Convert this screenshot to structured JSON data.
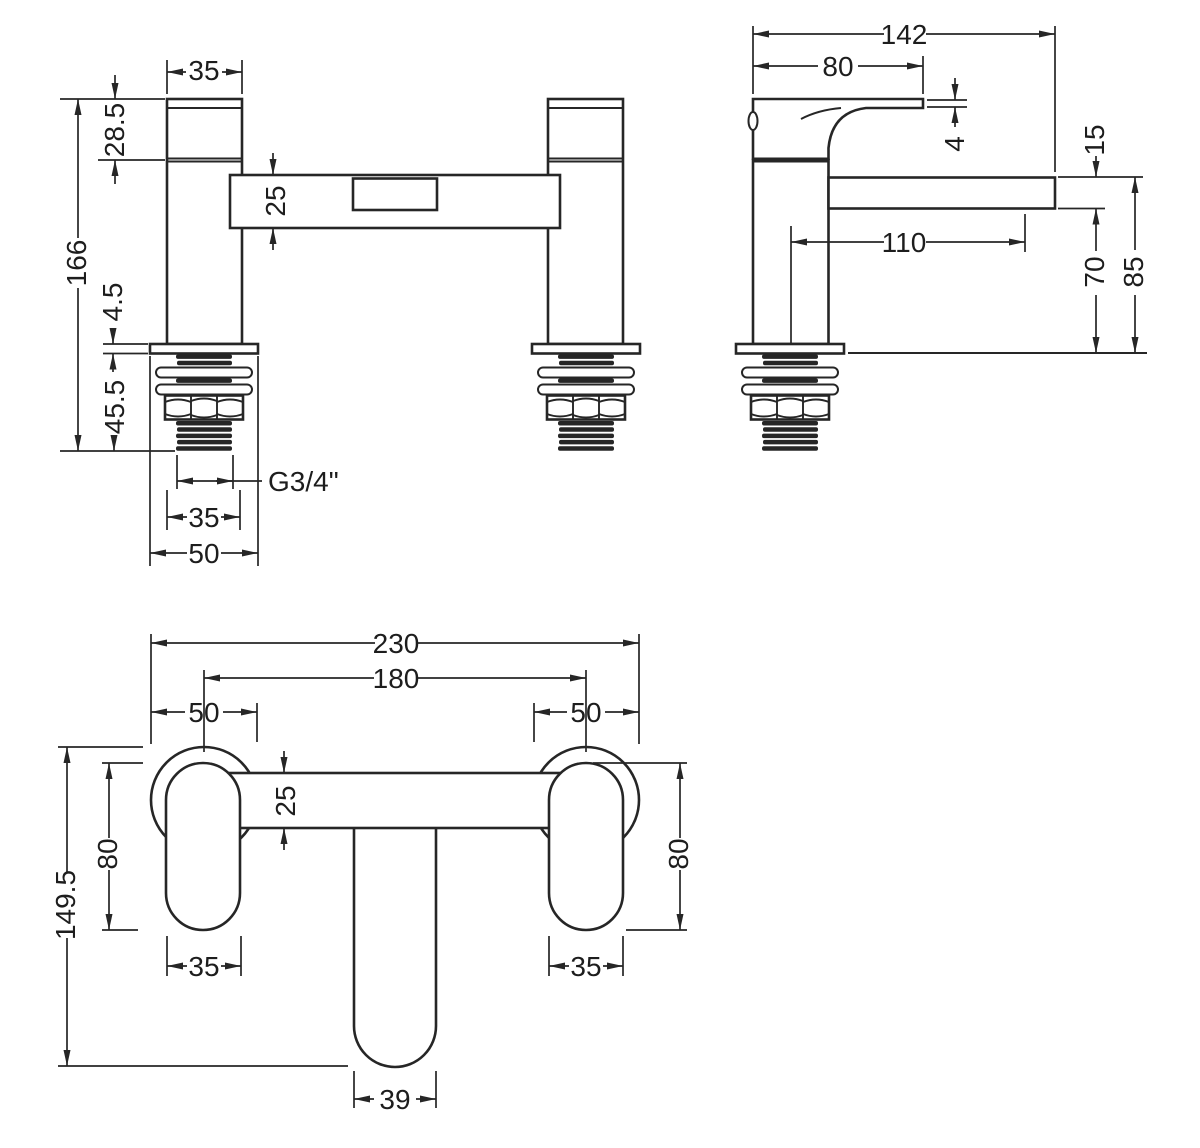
{
  "drawing": {
    "front": {
      "pillar_width": "35",
      "handle_height": "28.5",
      "bridge_height": "25",
      "total_height": "166",
      "flange_thickness": "4.5",
      "shank_length": "45.5",
      "thread_size": "G3/4\"",
      "thread_width": "35",
      "base_width": "50"
    },
    "side": {
      "total_depth": "142",
      "handle_depth": "80",
      "lever_thickness": "4",
      "spout_thickness": "15",
      "spout_reach": "110",
      "spout_clearance": "70",
      "spout_top_height": "85"
    },
    "plan": {
      "overall_width": "230",
      "hole_centres": "180",
      "base_left": "50",
      "base_right": "50",
      "bridge_depth": "25",
      "handle_left_length": "80",
      "handle_right_length": "80",
      "overall_depth": "149.5",
      "handle_left_width": "35",
      "handle_right_width": "35",
      "spout_width": "39"
    }
  }
}
